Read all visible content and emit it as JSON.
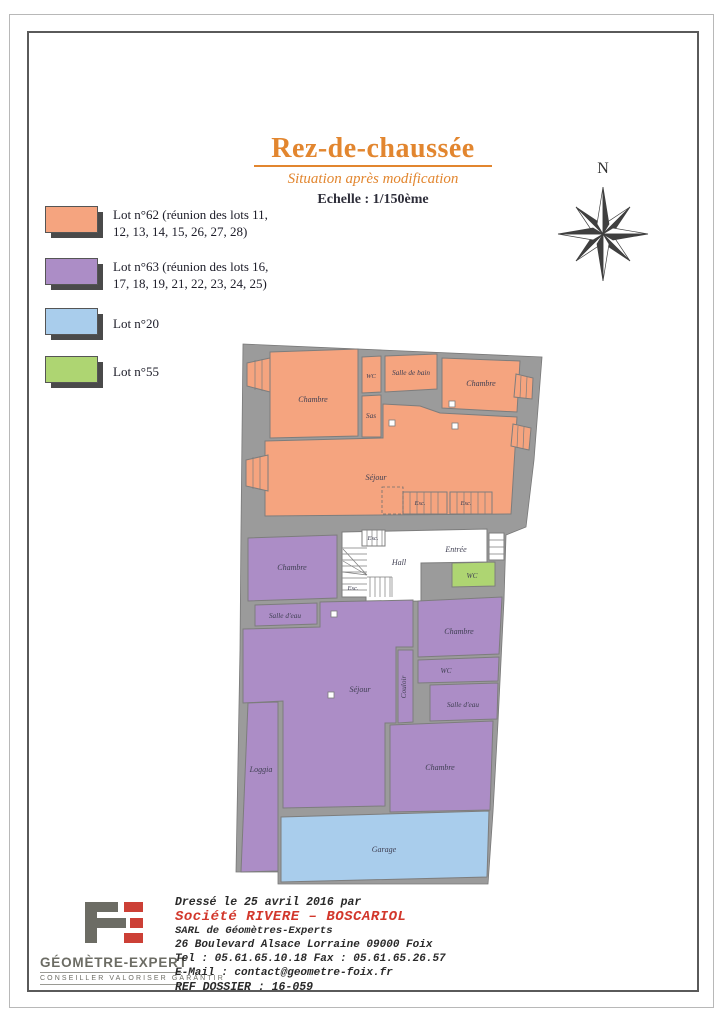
{
  "header": {
    "title": "Rez-de-chaussée",
    "subtitle": "Situation après modification",
    "scale": "Echelle : 1/150ème"
  },
  "compass": {
    "north_label": "N"
  },
  "legend": {
    "items": [
      {
        "line1": "Lot n°62 (réunion des lots 11,",
        "line2": "12, 13, 14, 15, 26, 27, 28)",
        "color": "#F5A47F"
      },
      {
        "line1": "Lot n°63 (réunion des lots 16,",
        "line2": "17, 18, 19, 21, 22, 23, 24, 25)",
        "color": "#AC8DC6"
      },
      {
        "line1": "Lot n°20",
        "line2": "",
        "color": "#A9CDEC"
      },
      {
        "line1": "Lot n°55",
        "line2": "",
        "color": "#AED572"
      }
    ]
  },
  "plan": {
    "colors": {
      "lot62": "#F5A47F",
      "lot63": "#AC8DC6",
      "lot20": "#A9CDEC",
      "lot55": "#AED572",
      "wall": "#9B9B9B",
      "room_white": "#FFFFFF"
    },
    "rooms": [
      {
        "label": "Chambre"
      },
      {
        "label": "WC"
      },
      {
        "label": "Salle de bain"
      },
      {
        "label": "Chambre"
      },
      {
        "label": "Sas"
      },
      {
        "label": "Séjour"
      },
      {
        "label": "Esc."
      },
      {
        "label": "Esc."
      },
      {
        "label": "Esc."
      },
      {
        "label": "Esc."
      },
      {
        "label": "Hall"
      },
      {
        "label": "Entrée"
      },
      {
        "label": "WC"
      },
      {
        "label": "Chambre"
      },
      {
        "label": "Salle d'eau"
      },
      {
        "label": "Séjour"
      },
      {
        "label": "Couloir"
      },
      {
        "label": "Chambre"
      },
      {
        "label": "WC"
      },
      {
        "label": "Salle d'eau"
      },
      {
        "label": "Chambre"
      },
      {
        "label": "Loggia"
      },
      {
        "label": "Garage"
      }
    ]
  },
  "footer": {
    "logo": {
      "name": "GÉOMÈTRE-EXPERT",
      "tagline": "CONSEILLER VALORISER GARANTIR"
    },
    "lines": {
      "drafted": "Dressé le 25 avril 2016  par",
      "company": "Société RIVERE – BOSCARIOL",
      "company_type": "SARL de Géomètres-Experts",
      "address": "26 Boulevard Alsace Lorraine 09000 Foix",
      "phone": "Tel : 05.61.65.10.18  Fax : 05.61.65.26.57",
      "email": "E-Mail : contact@geometre-foix.fr",
      "ref": "REF DOSSIER :  16-059"
    }
  }
}
